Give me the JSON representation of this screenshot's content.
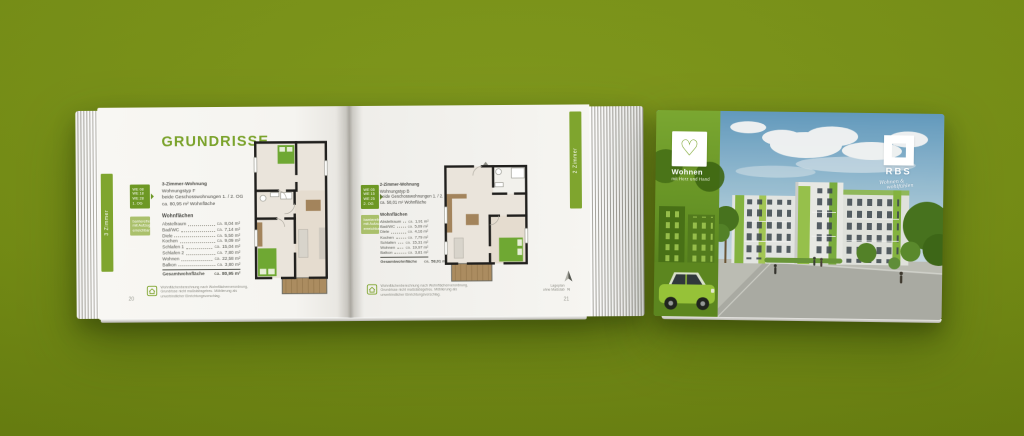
{
  "scene": {
    "background_color": "#76900f",
    "accent_green": "#7fa52e"
  },
  "icons": {
    "heart": "♡",
    "north": "N"
  },
  "brochure": {
    "left_page": {
      "page_number": "20",
      "side_tab_label": "3 Zimmer",
      "title": "GRUNDRISSE",
      "unit_box_lines": [
        "WE 08",
        "WE 18",
        "WE 28",
        "1. OG"
      ],
      "unit_box_light_lines": [
        "barrierefrei",
        "mit Aufzug",
        "erreichbar"
      ],
      "intro_lines": [
        "3-Zimmer-Wohnung",
        "Wohnungstyp F",
        "beide Geschosswohnungen 1. / 2. OG",
        "ca. 80,95 m² Wohnfläche"
      ],
      "areas_heading": "Wohnflächen",
      "area_rows": [
        {
          "name": "Abstellraum",
          "prefix": "ca.",
          "value": "8,04 m²"
        },
        {
          "name": "Bad/WC",
          "prefix": "ca.",
          "value": "7,14 m²"
        },
        {
          "name": "Diele",
          "prefix": "ca.",
          "value": "5,50 m²"
        },
        {
          "name": "Kochen",
          "prefix": "ca.",
          "value": "9,09 m²"
        },
        {
          "name": "Schlafen 1",
          "prefix": "ca.",
          "value": "15,04 m²"
        },
        {
          "name": "Schlafen 2",
          "prefix": "ca.",
          "value": "7,80 m²"
        },
        {
          "name": "Wohnen",
          "prefix": "ca.",
          "value": "22,58 m²"
        },
        {
          "name": "Balkon",
          "prefix": "ca.",
          "value": "3,80 m²"
        }
      ],
      "total_row": {
        "name": "Gesamtwohnfläche",
        "prefix": "ca.",
        "value": "80,95 m²"
      },
      "footnote_lines": [
        "Wohnflächenberechnung nach Wohnflächenverordnung,",
        "Grundrisse nicht maßstabsgetreu. Möblierung als",
        "unverbindlicher Einrichtungsvorschlag."
      ]
    },
    "right_page": {
      "page_number": "21",
      "side_tab_label": "2 Zimmer",
      "unit_box_lines": [
        "WE 05",
        "WE 15",
        "WE 25",
        "2. OG"
      ],
      "unit_box_light_lines": [
        "barrierefrei",
        "mit Aufzug",
        "erreichbar"
      ],
      "intro_lines": [
        "2-Zimmer-Wohnung",
        "Wohnungstyp B",
        "beide Geschosswohnungen 1. / 2. OG",
        "ca. 58,01 m² Wohnfläche"
      ],
      "areas_heading": "Wohnflächen",
      "area_rows": [
        {
          "name": "Abstellraum",
          "prefix": "ca.",
          "value": "1,91 m²"
        },
        {
          "name": "Bad/WC",
          "prefix": "ca.",
          "value": "5,09 m²"
        },
        {
          "name": "Diele",
          "prefix": "ca.",
          "value": "4,16 m²"
        },
        {
          "name": "Kochen",
          "prefix": "ca.",
          "value": "7,79 m²"
        },
        {
          "name": "Schlafen",
          "prefix": "ca.",
          "value": "15,31 m²"
        },
        {
          "name": "Wohnen",
          "prefix": "ca.",
          "value": "19,97 m²"
        },
        {
          "name": "Balkon",
          "prefix": "ca.",
          "value": "3,81 m²"
        }
      ],
      "total_row": {
        "name": "Gesamtwohnfläche",
        "prefix": "ca.",
        "value": "58,01 m²"
      },
      "compass": {
        "label": "N",
        "caption_lines": [
          "Lageplan",
          "ohne Maßstab"
        ]
      },
      "footnote_lines": [
        "Wohnflächenberechnung nach Wohnflächenverordnung,",
        "Grundrisse nicht maßstabsgetreu. Möblierung als",
        "unverbindlicher Einrichtungsvorschlag."
      ]
    }
  },
  "cover": {
    "brand": {
      "title": "Wohnen",
      "subtitle": "mit Herz und Hand"
    },
    "rbs": {
      "name": "RBS",
      "script_line1": "Wohnen &",
      "script_line2": "wohlfühlen"
    }
  }
}
